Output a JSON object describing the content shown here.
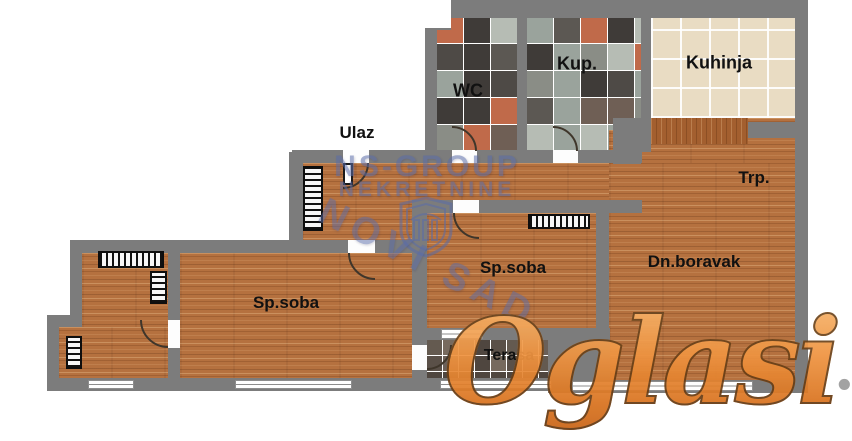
{
  "plan": {
    "rooms": {
      "wc": "WC",
      "kupatilo": "Kup.",
      "kuhinja": "Kuhinja",
      "ulaz": "Ulaz",
      "trpezarija": "Trp.",
      "dnevni_boravak": "Dn.boravak",
      "spavaca_soba_1": "Sp.soba",
      "spavaca_soba_2": "Sp.soba",
      "terasa": "Terasa"
    }
  },
  "watermarks": {
    "agency_line1": "NS-GROUP",
    "agency_line2": "NEKRETNINE",
    "agency_city": "NOVI SAD",
    "portal_name": "Oglasi",
    "portal_tld": ".rs"
  },
  "colors": {
    "wall": "#7c7c7c",
    "wood": "#b5713f",
    "wood_dark": "#a35f2f",
    "kitchen_tile": "#e9dcc3",
    "kitchen_grout": "rgba(255,255,255,0.92)",
    "bathroom_tiles": [
      "#9aa39c",
      "#4e4a46",
      "#c06a4a",
      "#6f5f55",
      "#b6bcb4",
      "#5c5853",
      "#8a8d86",
      "#3f3b38"
    ],
    "terrace_tiles": [
      "#6b6058",
      "#5a5048",
      "#776a5e",
      "#4f463f",
      "#645a50"
    ],
    "watermark_blue": "#5a6ca8",
    "portal_orange": "#ef9441",
    "portal_tld_gray": "#9b9b9b",
    "label_color": "#111111"
  }
}
